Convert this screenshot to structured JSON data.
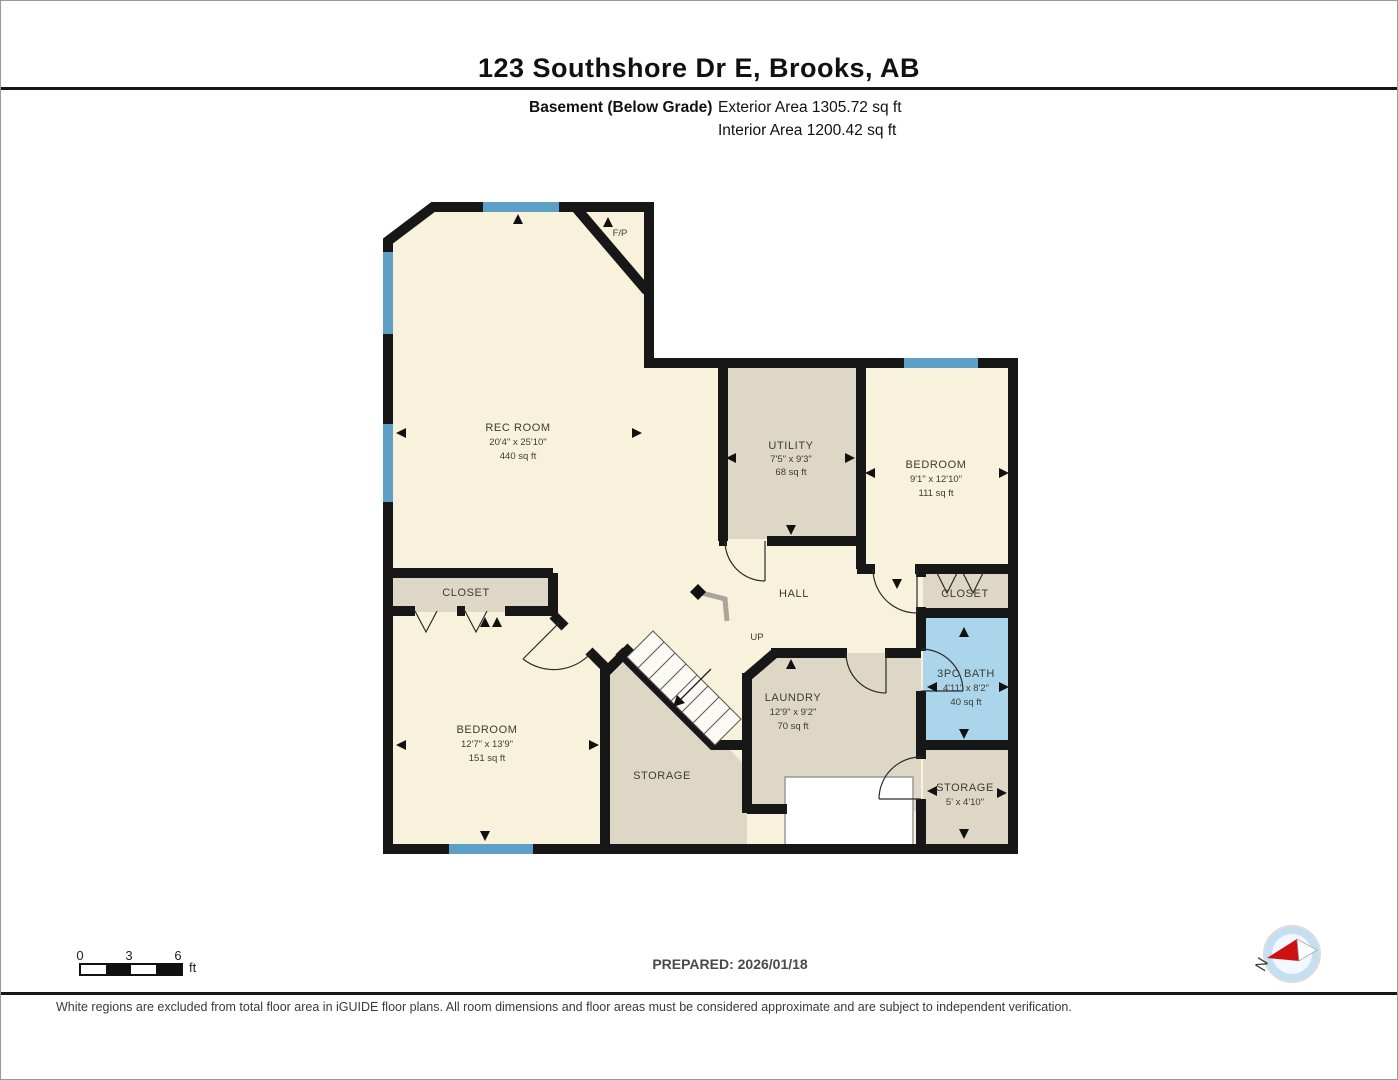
{
  "header": {
    "title": "123 Southshore Dr E, Brooks, AB",
    "floor_label": "Basement (Below Grade)",
    "exterior_area": "Exterior Area 1305.72 sq ft",
    "interior_area": "Interior Area 1200.42 sq ft"
  },
  "rooms": {
    "rec_room": {
      "name": "REC ROOM",
      "dims": "20'4\" x 25'10\"",
      "area": "440 sq ft"
    },
    "utility": {
      "name": "UTILITY",
      "dims": "7'5\" x 9'3\"",
      "area": "68 sq ft"
    },
    "bedroom_ne": {
      "name": "BEDROOM",
      "dims": "9'1\" x 12'10\"",
      "area": "111 sq ft"
    },
    "bedroom_sw": {
      "name": "BEDROOM",
      "dims": "12'7\" x 13'9\"",
      "area": "151 sq ft"
    },
    "bath": {
      "name": "3PC BATH",
      "dims": "4'11\" x 8'2\"",
      "area": "40 sq ft"
    },
    "laundry": {
      "name": "LAUNDRY",
      "dims": "12'9\" x 9'2\"",
      "area": "70 sq ft"
    },
    "storage_mid": {
      "name": "STORAGE"
    },
    "storage_se": {
      "name": "STORAGE",
      "dims": "5' x 4'10\""
    },
    "hall": {
      "name": "HALL"
    },
    "closet_w": {
      "name": "CLOSET"
    },
    "closet_e": {
      "name": "CLOSET"
    },
    "fireplace": {
      "name": "F/P"
    },
    "stairs": {
      "name": "UP"
    }
  },
  "footer": {
    "prepared": "PREPARED: 2026/01/18",
    "disclaimer": "White regions are excluded from total floor area in iGUIDE floor plans. All room dimensions and floor areas must be considered approximate and are subject to independent verification.",
    "scale": {
      "ticks": [
        "0",
        "3",
        "6"
      ],
      "unit": "ft"
    },
    "compass_letter": "N"
  },
  "colors": {
    "wall": "#171717",
    "floor_main": "#F8F2DC",
    "floor_service": "#DFD7C5",
    "floor_bath": "#ABD5EA",
    "window": "#5E9FC6",
    "excluded": "#FFFFFF"
  }
}
